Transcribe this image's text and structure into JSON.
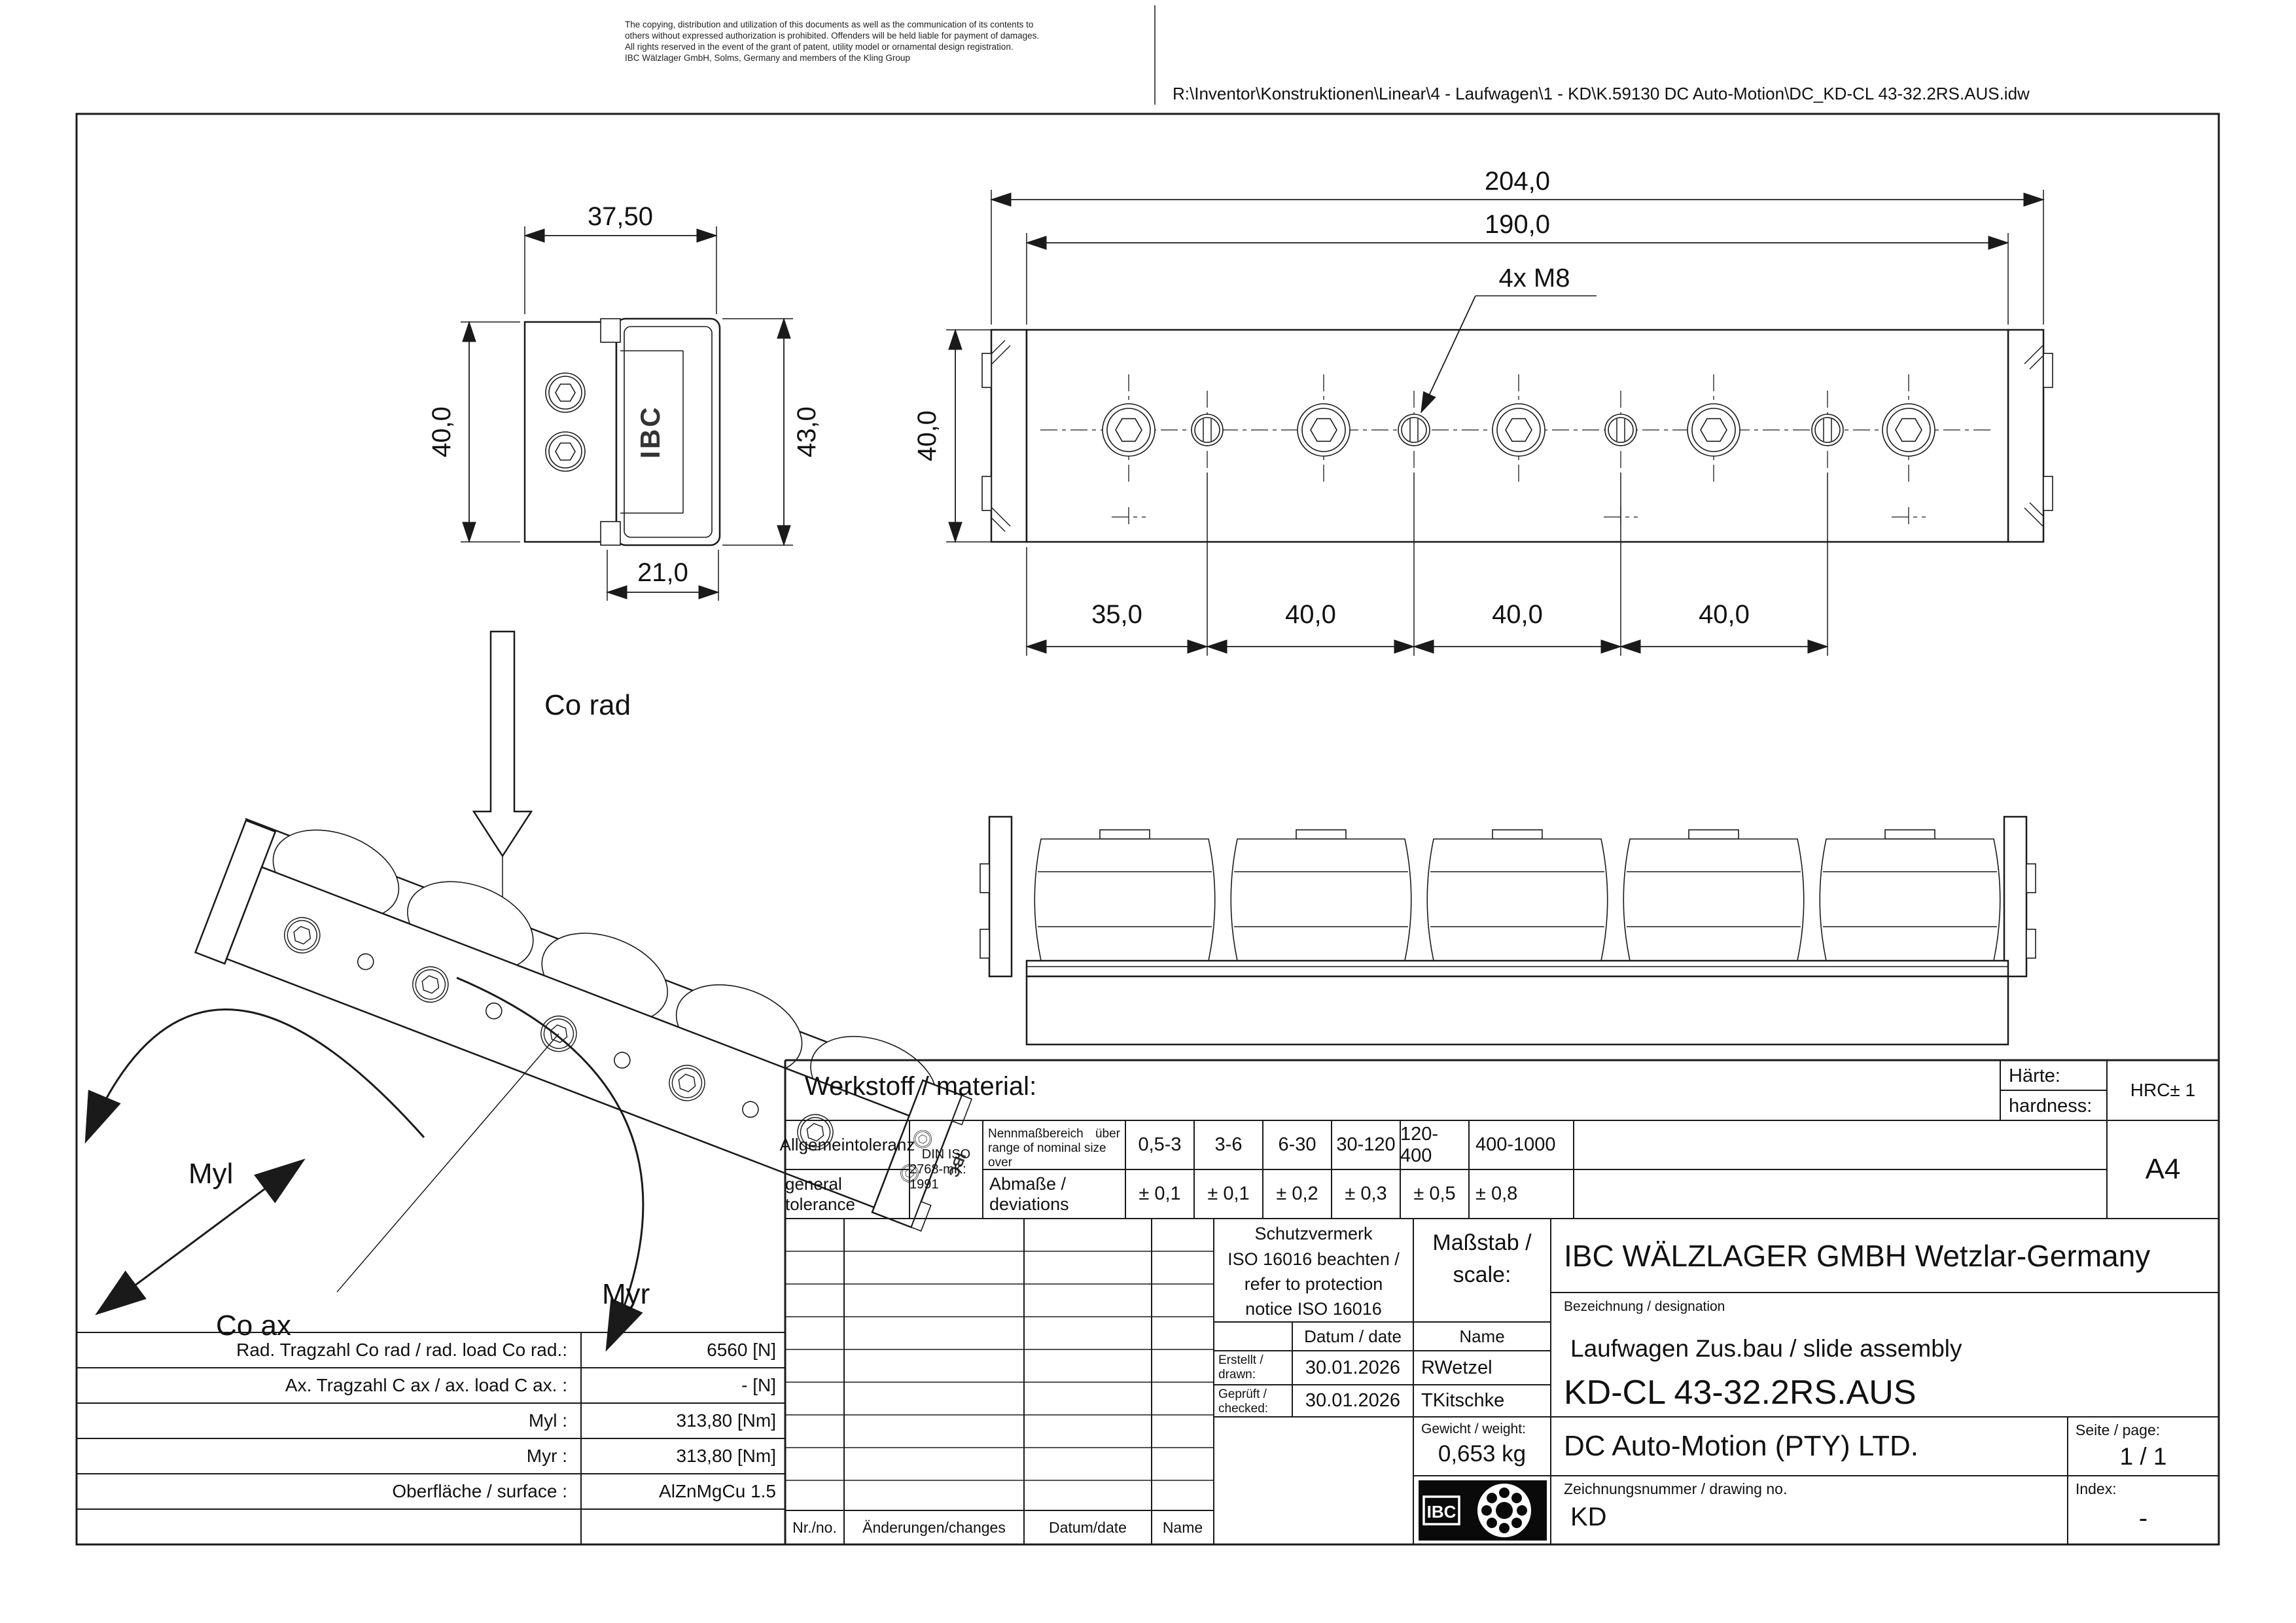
{
  "header": {
    "disclaimer": [
      "The copying, distribution and utilization of this documents as well as the communication of its contents to",
      "others without expressed authorization is prohibited. Offenders will be held liable for payment of damages.",
      "All rights reserved in the event of the grant of patent, utility model or ornamental design registration.",
      "IBC Wälzlager GmbH, Solms, Germany and members of the Kling Group"
    ],
    "file_path": "R:\\Inventor\\Konstruktionen\\Linear\\4 - Laufwagen\\1 - KD\\K.59130 DC Auto-Motion\\DC_KD-CL 43-32.2RS.AUS.idw"
  },
  "views": {
    "end_view": {
      "dim_width": "37,50",
      "dim_height_left": "40,0",
      "dim_height_right": "43,0",
      "dim_base": "21,0",
      "logo_text": "IBC"
    },
    "top_view": {
      "dim_total": "204,0",
      "dim_body": "190,0",
      "thread_callout": "4x M8",
      "dim_height": "40,0",
      "dim_p1": "35,0",
      "dim_p2": "40,0",
      "dim_p3": "40,0",
      "dim_p4": "40,0"
    },
    "iso_view": {
      "co_rad": "Co rad",
      "myl": "Myl",
      "co_ax": "Co ax",
      "myr": "Myr",
      "logo_text": "IBC"
    }
  },
  "load_table": {
    "rows": [
      {
        "label": "Rad. Tragzahl Co rad / rad. load Co rad.:",
        "value": "6560  [N]"
      },
      {
        "label": "Ax. Tragzahl C ax / ax. load C ax. :",
        "value": "- [N]"
      },
      {
        "label": "Myl :",
        "value": "313,80 [Nm]"
      },
      {
        "label": "Myr :",
        "value": "313,80 [Nm]"
      },
      {
        "label": "Oberfläche / surface :",
        "value": "AlZnMgCu 1.5"
      }
    ]
  },
  "tolerance": {
    "material_label": "Werkstoff / material:",
    "hardness_de": "Härte:",
    "hardness_en": "hardness:",
    "hardness_value": "HRC± 1",
    "sheet_format": "A4",
    "general_de": "Allgemeintoleranz",
    "general_en": "general tolerance",
    "standard_line1": "DIN ISO",
    "standard_line2": "2768-mK: 1991",
    "range_de": "Nennmaßbereich",
    "range_over": "über",
    "range_en": "range of nominal size over",
    "dev_label": "Abmaße / deviations",
    "ranges": [
      "0,5-3",
      "3-6",
      "6-30",
      "30-120",
      "120-400",
      "400-1000"
    ],
    "deviations": [
      "± 0,1",
      "± 0,1",
      "± 0,2",
      "± 0,3",
      "± 0,5",
      "± 0,8"
    ]
  },
  "title_block": {
    "protection_l1": "Schutzvermerk",
    "protection_l2": "ISO 16016 beachten /",
    "protection_l3": "refer to protection",
    "protection_l4": "notice ISO 16016",
    "scale_l1": "Maßstab /",
    "scale_l2": "scale:",
    "date_header": "Datum / date",
    "name_header": "Name",
    "drawn_l1": "Erstellt /",
    "drawn_l2": "drawn:",
    "drawn_date": "30.01.2026",
    "drawn_name": "RWetzel",
    "checked_l1": "Geprüft /",
    "checked_l2": "checked:",
    "checked_date": "30.01.2026",
    "checked_name": "TKitschke",
    "weight_label": "Gewicht / weight:",
    "weight_value": "0,653 kg",
    "company": "IBC WÄLZLAGER GMBH Wetzlar-Germany",
    "designation_label": "Bezeichnung / designation",
    "designation": "Laufwagen Zus.bau / slide assembly",
    "part_number": "KD-CL 43-32.2RS.AUS",
    "customer": "DC Auto-Motion (PTY) LTD.",
    "page_label": "Seite / page:",
    "page_value": "1 / 1",
    "drawing_no_label": "Zeichnungsnummer / drawing no.",
    "drawing_no": "KD",
    "index_label": "Index:",
    "index_value": "-",
    "logo_text": "IBC"
  },
  "revision": {
    "no": "Nr./no.",
    "changes": "Änderungen/changes",
    "date": "Datum/date",
    "name": "Name"
  }
}
